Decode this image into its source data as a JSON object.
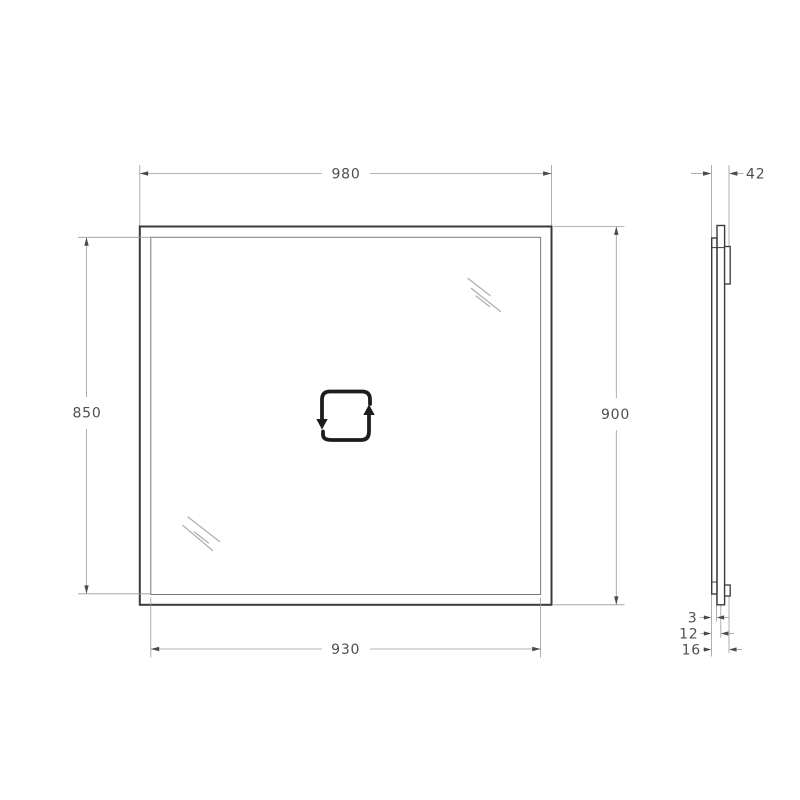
{
  "front_view": {
    "top_width_label": "980",
    "left_height_label": "850",
    "right_height_label": "900",
    "bottom_width_label": "930"
  },
  "side_view": {
    "total_depth_label": "42",
    "glass_thickness_label": "3",
    "mid_depth_label": "12",
    "frame_depth_label": "16"
  },
  "icons": {
    "center_icon": "square-loop-arrows-icon",
    "shine_marks": "glass-reflection-lines"
  },
  "colors": {
    "background": "#ffffff",
    "object_line": "#3b3b3b",
    "inner_edge_line": "#787878",
    "dimension_line": "#9b9b9b",
    "label_text": "#4f4f4f",
    "icon": "#1d1d1d",
    "shine": "#b0b0b0"
  }
}
